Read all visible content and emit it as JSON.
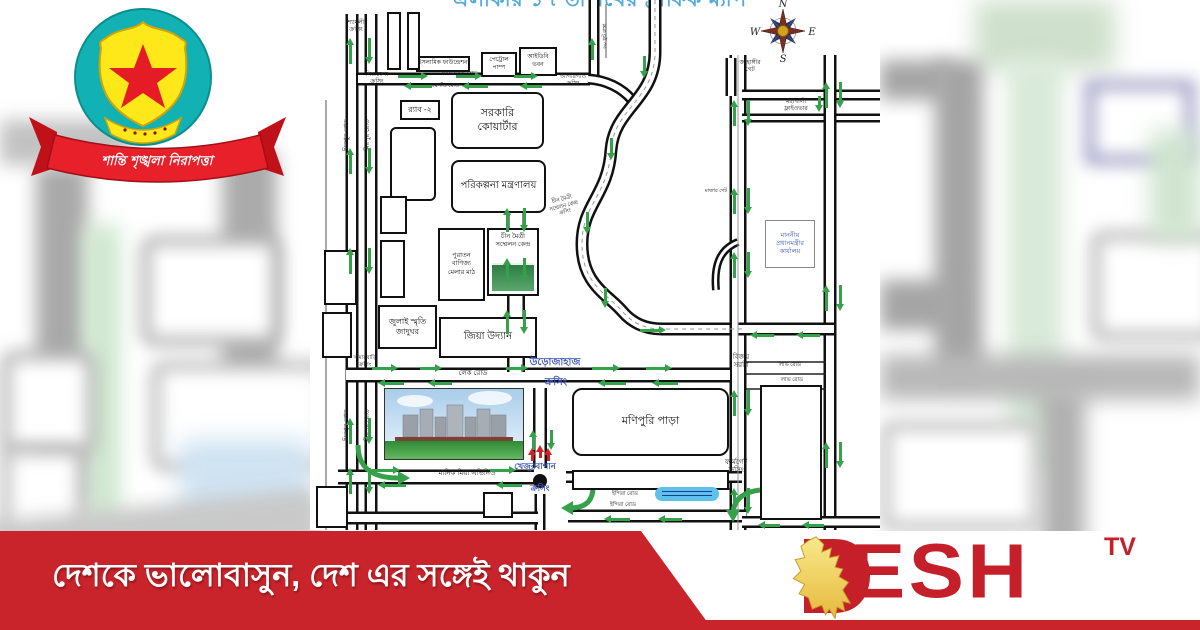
{
  "colors": {
    "arrow_green": "#35a14a",
    "arrow_red": "#d42020",
    "band_red": "#c9242b",
    "brand_red": "#c5202a",
    "crossing_blue": "#3b55b5",
    "title_blue": "#56abdd",
    "logo_teal": "#12b2b4",
    "logo_yellow": "#ffe81a"
  },
  "logo_dmp": {
    "motto": "শান্তি শৃঙ্খলা নিরাপত্তা"
  },
  "banner": {
    "tagline": "দেশকে ভালোবাসুন, দেশ এর সঙ্গেই থাকুন"
  },
  "brand": {
    "name": "DESH",
    "tv": "TV"
  },
  "map": {
    "title_partial": "এলাকার ১৭ তারিখের ট্রাফিক ম্যাপ",
    "compass": {
      "n": "N",
      "s": "S",
      "e": "E",
      "w": "W"
    },
    "boxes": [
      {
        "id": "govt-quarters",
        "label": "সরকারি\nকোয়ার্টার",
        "x": 141,
        "y": 92,
        "w": 93,
        "h": 57,
        "fs": 11,
        "r": 8
      },
      {
        "id": "planning-ministry",
        "label": "পরিকল্পনা মন্ত্রণালয়",
        "x": 141,
        "y": 160,
        "w": 95,
        "h": 53,
        "fs": 10,
        "r": 8
      },
      {
        "id": "rab-2",
        "label": "র‍্যাব -২",
        "x": 90,
        "y": 100,
        "w": 40,
        "h": 20,
        "fs": 8
      },
      {
        "id": "btv-block",
        "label": "",
        "x": 80,
        "y": 127,
        "w": 46,
        "h": 74,
        "fs": 6,
        "r": 6
      },
      {
        "id": "islamic-foundation",
        "label": "ইসলামিক ফাউন্ডেশন",
        "x": 106,
        "y": 56,
        "w": 54,
        "h": 16,
        "fs": 6
      },
      {
        "id": "petrol-pump",
        "label": "পেট্রোল\nপাম্প",
        "x": 171,
        "y": 52,
        "w": 36,
        "h": 25,
        "fs": 6
      },
      {
        "id": "idb-bhaban",
        "label": "আইডিবি\nভবন",
        "x": 209,
        "y": 47,
        "w": 38,
        "h": 29,
        "fs": 6
      },
      {
        "id": "chin-maitree",
        "label": "চীন মৈত্রী\nসম্মেলন কেন্দ্র",
        "x": 177,
        "y": 228,
        "w": 52,
        "h": 68,
        "fs": 6.5,
        "img": "green"
      },
      {
        "id": "trade-fair-ground",
        "label": "পুরাতন\nবাণিজ্য\nমেলার মাঠ",
        "x": 128,
        "y": 228,
        "w": 47,
        "h": 73,
        "fs": 6.5
      },
      {
        "id": "july-museum",
        "label": "জুলাই স্মৃতি\nজাদুঘর",
        "x": 68,
        "y": 305,
        "w": 59,
        "h": 44,
        "fs": 8
      },
      {
        "id": "zia-uddan",
        "label": "জিয়া উদ্যান",
        "x": 129,
        "y": 317,
        "w": 98,
        "h": 41,
        "fs": 10
      },
      {
        "id": "monipuri-para",
        "label": "মণিপুরি পাড়া",
        "x": 262,
        "y": 388,
        "w": 157,
        "h": 68,
        "fs": 11,
        "r": 10
      },
      {
        "id": "pm-office",
        "label": "মাননীয়\nপ্রধানমন্ত্রীর\nকার্যালয়",
        "x": 455,
        "y": 220,
        "w": 50,
        "h": 48,
        "fs": 6.5,
        "color": "#3b55b5",
        "thin": true
      },
      {
        "id": "tejgaon-block",
        "label": "",
        "x": 450,
        "y": 385,
        "w": 62,
        "h": 135,
        "fs": 6
      },
      {
        "id": "strip-block",
        "label": "",
        "x": 262,
        "y": 470,
        "w": 157,
        "h": 20,
        "fs": 6
      },
      {
        "id": "small-a",
        "label": "",
        "x": 70,
        "y": 196,
        "w": 27,
        "h": 38,
        "fs": 5
      },
      {
        "id": "small-b",
        "label": "",
        "x": 70,
        "y": 240,
        "w": 25,
        "h": 58,
        "fs": 5
      },
      {
        "id": "small-c",
        "label": "",
        "x": 14,
        "y": 250,
        "w": 33,
        "h": 55,
        "fs": 5
      },
      {
        "id": "small-d",
        "label": "",
        "x": 12,
        "y": 312,
        "w": 30,
        "h": 46,
        "fs": 5
      },
      {
        "id": "small-e",
        "label": "",
        "x": 6,
        "y": 486,
        "w": 32,
        "h": 42,
        "fs": 5
      },
      {
        "id": "school-block",
        "label": "",
        "x": 173,
        "y": 492,
        "w": 30,
        "h": 26,
        "fs": 5
      },
      {
        "id": "tall-1",
        "label": "",
        "x": 77,
        "y": 12,
        "w": 14,
        "h": 58,
        "fs": 5
      },
      {
        "id": "tall-2",
        "label": "",
        "x": 97,
        "y": 12,
        "w": 13,
        "h": 58,
        "fs": 5
      }
    ],
    "labels": [
      {
        "t": "শ্যামলী\nক্রসিং",
        "x": 26,
        "y": 20,
        "w": 40,
        "fs": 6
      },
      {
        "t": "শিশুমেলা\nক্রসিং",
        "x": 47,
        "y": 72,
        "w": 40,
        "fs": 6
      },
      {
        "t": "আগারগাঁও রোড",
        "x": 118,
        "y": 71,
        "w": 62,
        "fs": 5.5
      },
      {
        "t": "আগারগাঁও রোড",
        "x": 100,
        "y": 83,
        "w": 62,
        "fs": 5.5
      },
      {
        "t": "আগারগাঁও\nক্রসিং",
        "x": 241,
        "y": 74,
        "w": 44,
        "fs": 6
      },
      {
        "t": "মিরপুর রোড",
        "x": 33,
        "y": 158,
        "w": 46,
        "fs": 6.5,
        "rot": -90
      },
      {
        "t": "মিরপুর রোড",
        "x": 54,
        "y": 158,
        "w": 46,
        "fs": 6.5,
        "rot": -90
      },
      {
        "t": "মিরপুর রোড",
        "x": 33,
        "y": 448,
        "w": 46,
        "fs": 6.5,
        "rot": -90
      },
      {
        "t": "মিরপুর রোড",
        "x": 54,
        "y": 448,
        "w": 46,
        "fs": 6.5,
        "rot": -90
      },
      {
        "t": "৬০ ফুট রাস্তা",
        "x": 292,
        "y": 58,
        "w": 44,
        "fs": 5,
        "rot": -90
      },
      {
        "t": "জাহাঙ্গীর\nগেট",
        "x": 420,
        "y": 60,
        "w": 40,
        "fs": 6
      },
      {
        "t": "মহাখালী\nফ্লাইওভার",
        "x": 463,
        "y": 99,
        "w": 46,
        "fs": 6
      },
      {
        "t": "চীন মৈত্রী\nসম্মেলন কেন্দ্র\nক্রসিং",
        "x": 228,
        "y": 203,
        "w": 48,
        "fs": 5.5,
        "rot": -15
      },
      {
        "t": "মাজার গেট",
        "x": 390,
        "y": 188,
        "w": 32,
        "fs": 5
      },
      {
        "t": "লেক রোড",
        "x": 136,
        "y": 370,
        "w": 54,
        "fs": 7
      },
      {
        "t": "উড়োজাহাজ",
        "x": 213,
        "y": 357,
        "w": 64,
        "fs": 10,
        "c": "#3b55b5",
        "b": 1
      },
      {
        "t": "ক্রসিং",
        "x": 226,
        "y": 377,
        "w": 40,
        "fs": 10,
        "c": "#3b55b5",
        "b": 1
      },
      {
        "t": "খামারবাড়ি\nক্রসিং",
        "x": 34,
        "y": 355,
        "w": 42,
        "fs": 5.5
      },
      {
        "t": "বিজয়\nসরণি",
        "x": 416,
        "y": 354,
        "w": 30,
        "fs": 7
      },
      {
        "t": "লাভ রোড",
        "x": 461,
        "y": 362,
        "w": 38,
        "fs": 5.5
      },
      {
        "t": "লাভ রোড",
        "x": 463,
        "y": 377,
        "w": 38,
        "fs": 5.5
      },
      {
        "t": "মানিক মিয়া এভিনিউ",
        "x": 118,
        "y": 470,
        "w": 78,
        "fs": 7
      },
      {
        "t": "খেজুরবাগান",
        "x": 198,
        "y": 461,
        "w": 54,
        "fs": 8.5,
        "c": "#3b55b5",
        "b": 1
      },
      {
        "t": "ক্রসিং",
        "x": 212,
        "y": 483,
        "w": 36,
        "fs": 8.5,
        "c": "#3b55b5",
        "b": 1
      },
      {
        "t": "ইন্দিরা রোড",
        "x": 294,
        "y": 491,
        "w": 42,
        "fs": 5.5
      },
      {
        "t": "ইন্দিরা রোড",
        "x": 292,
        "y": 502,
        "w": 42,
        "fs": 5.5
      },
      {
        "t": "ফার্মগেট\nক্রসিং",
        "x": 405,
        "y": 459,
        "w": 42,
        "fs": 7
      }
    ],
    "arrows": [
      [
        36,
        38,
        "up",
        26
      ],
      [
        36,
        148,
        "up",
        26
      ],
      [
        36,
        248,
        "up",
        26
      ],
      [
        36,
        418,
        "up",
        26
      ],
      [
        36,
        468,
        "up",
        26
      ],
      [
        55,
        38,
        "down",
        26
      ],
      [
        55,
        148,
        "down",
        26
      ],
      [
        55,
        248,
        "down",
        26
      ],
      [
        55,
        418,
        "down",
        26
      ],
      [
        55,
        468,
        "down",
        26
      ],
      [
        88,
        72,
        "right",
        30
      ],
      [
        146,
        72,
        "right",
        26
      ],
      [
        204,
        72,
        "right",
        24
      ],
      [
        94,
        82,
        "left",
        28
      ],
      [
        152,
        82,
        "left",
        26
      ],
      [
        210,
        82,
        "left",
        22
      ],
      [
        278,
        38,
        "up",
        22
      ],
      [
        330,
        56,
        "down",
        22
      ],
      [
        297,
        138,
        "down",
        22
      ],
      [
        273,
        212,
        "down",
        22
      ],
      [
        291,
        288,
        "down",
        20
      ],
      [
        330,
        326,
        "right",
        26
      ],
      [
        440,
        331,
        "left",
        24
      ],
      [
        486,
        331,
        "left",
        24
      ],
      [
        193,
        208,
        "up",
        24
      ],
      [
        193,
        258,
        "up",
        24
      ],
      [
        193,
        310,
        "up",
        24
      ],
      [
        210,
        208,
        "down",
        24
      ],
      [
        210,
        258,
        "down",
        24
      ],
      [
        210,
        310,
        "down",
        24
      ],
      [
        219,
        430,
        "up",
        20
      ],
      [
        237,
        430,
        "down",
        20
      ],
      [
        420,
        100,
        "up",
        26
      ],
      [
        420,
        188,
        "up",
        26
      ],
      [
        420,
        252,
        "up",
        26
      ],
      [
        420,
        390,
        "up",
        26
      ],
      [
        420,
        488,
        "up",
        26
      ],
      [
        434,
        100,
        "down",
        26
      ],
      [
        434,
        188,
        "down",
        26
      ],
      [
        434,
        252,
        "down",
        26
      ],
      [
        434,
        390,
        "down",
        26
      ],
      [
        434,
        488,
        "down",
        26
      ],
      [
        512,
        82,
        "up",
        26
      ],
      [
        512,
        285,
        "up",
        26
      ],
      [
        512,
        442,
        "up",
        26
      ],
      [
        526,
        82,
        "down",
        26
      ],
      [
        526,
        285,
        "down",
        26
      ],
      [
        526,
        442,
        "down",
        26
      ],
      [
        505,
        96,
        "down",
        16
      ],
      [
        62,
        364,
        "right",
        26
      ],
      [
        110,
        364,
        "right",
        22
      ],
      [
        196,
        364,
        "right",
        22
      ],
      [
        68,
        379,
        "left",
        26
      ],
      [
        118,
        379,
        "left",
        24
      ],
      [
        282,
        364,
        "right",
        28
      ],
      [
        336,
        364,
        "right",
        26
      ],
      [
        288,
        379,
        "left",
        28
      ],
      [
        342,
        379,
        "left",
        26
      ],
      [
        62,
        466,
        "right",
        28
      ],
      [
        180,
        466,
        "right",
        26
      ],
      [
        68,
        481,
        "left",
        28
      ],
      [
        186,
        481,
        "left",
        26
      ],
      [
        294,
        515,
        "left",
        26
      ],
      [
        348,
        515,
        "left",
        24
      ],
      [
        448,
        521,
        "left",
        22
      ],
      [
        492,
        521,
        "left",
        22
      ],
      [
        218,
        448,
        "up",
        13,
        "red"
      ],
      [
        226,
        445,
        "up",
        13,
        "red"
      ],
      [
        234,
        448,
        "up",
        13,
        "red"
      ]
    ]
  }
}
